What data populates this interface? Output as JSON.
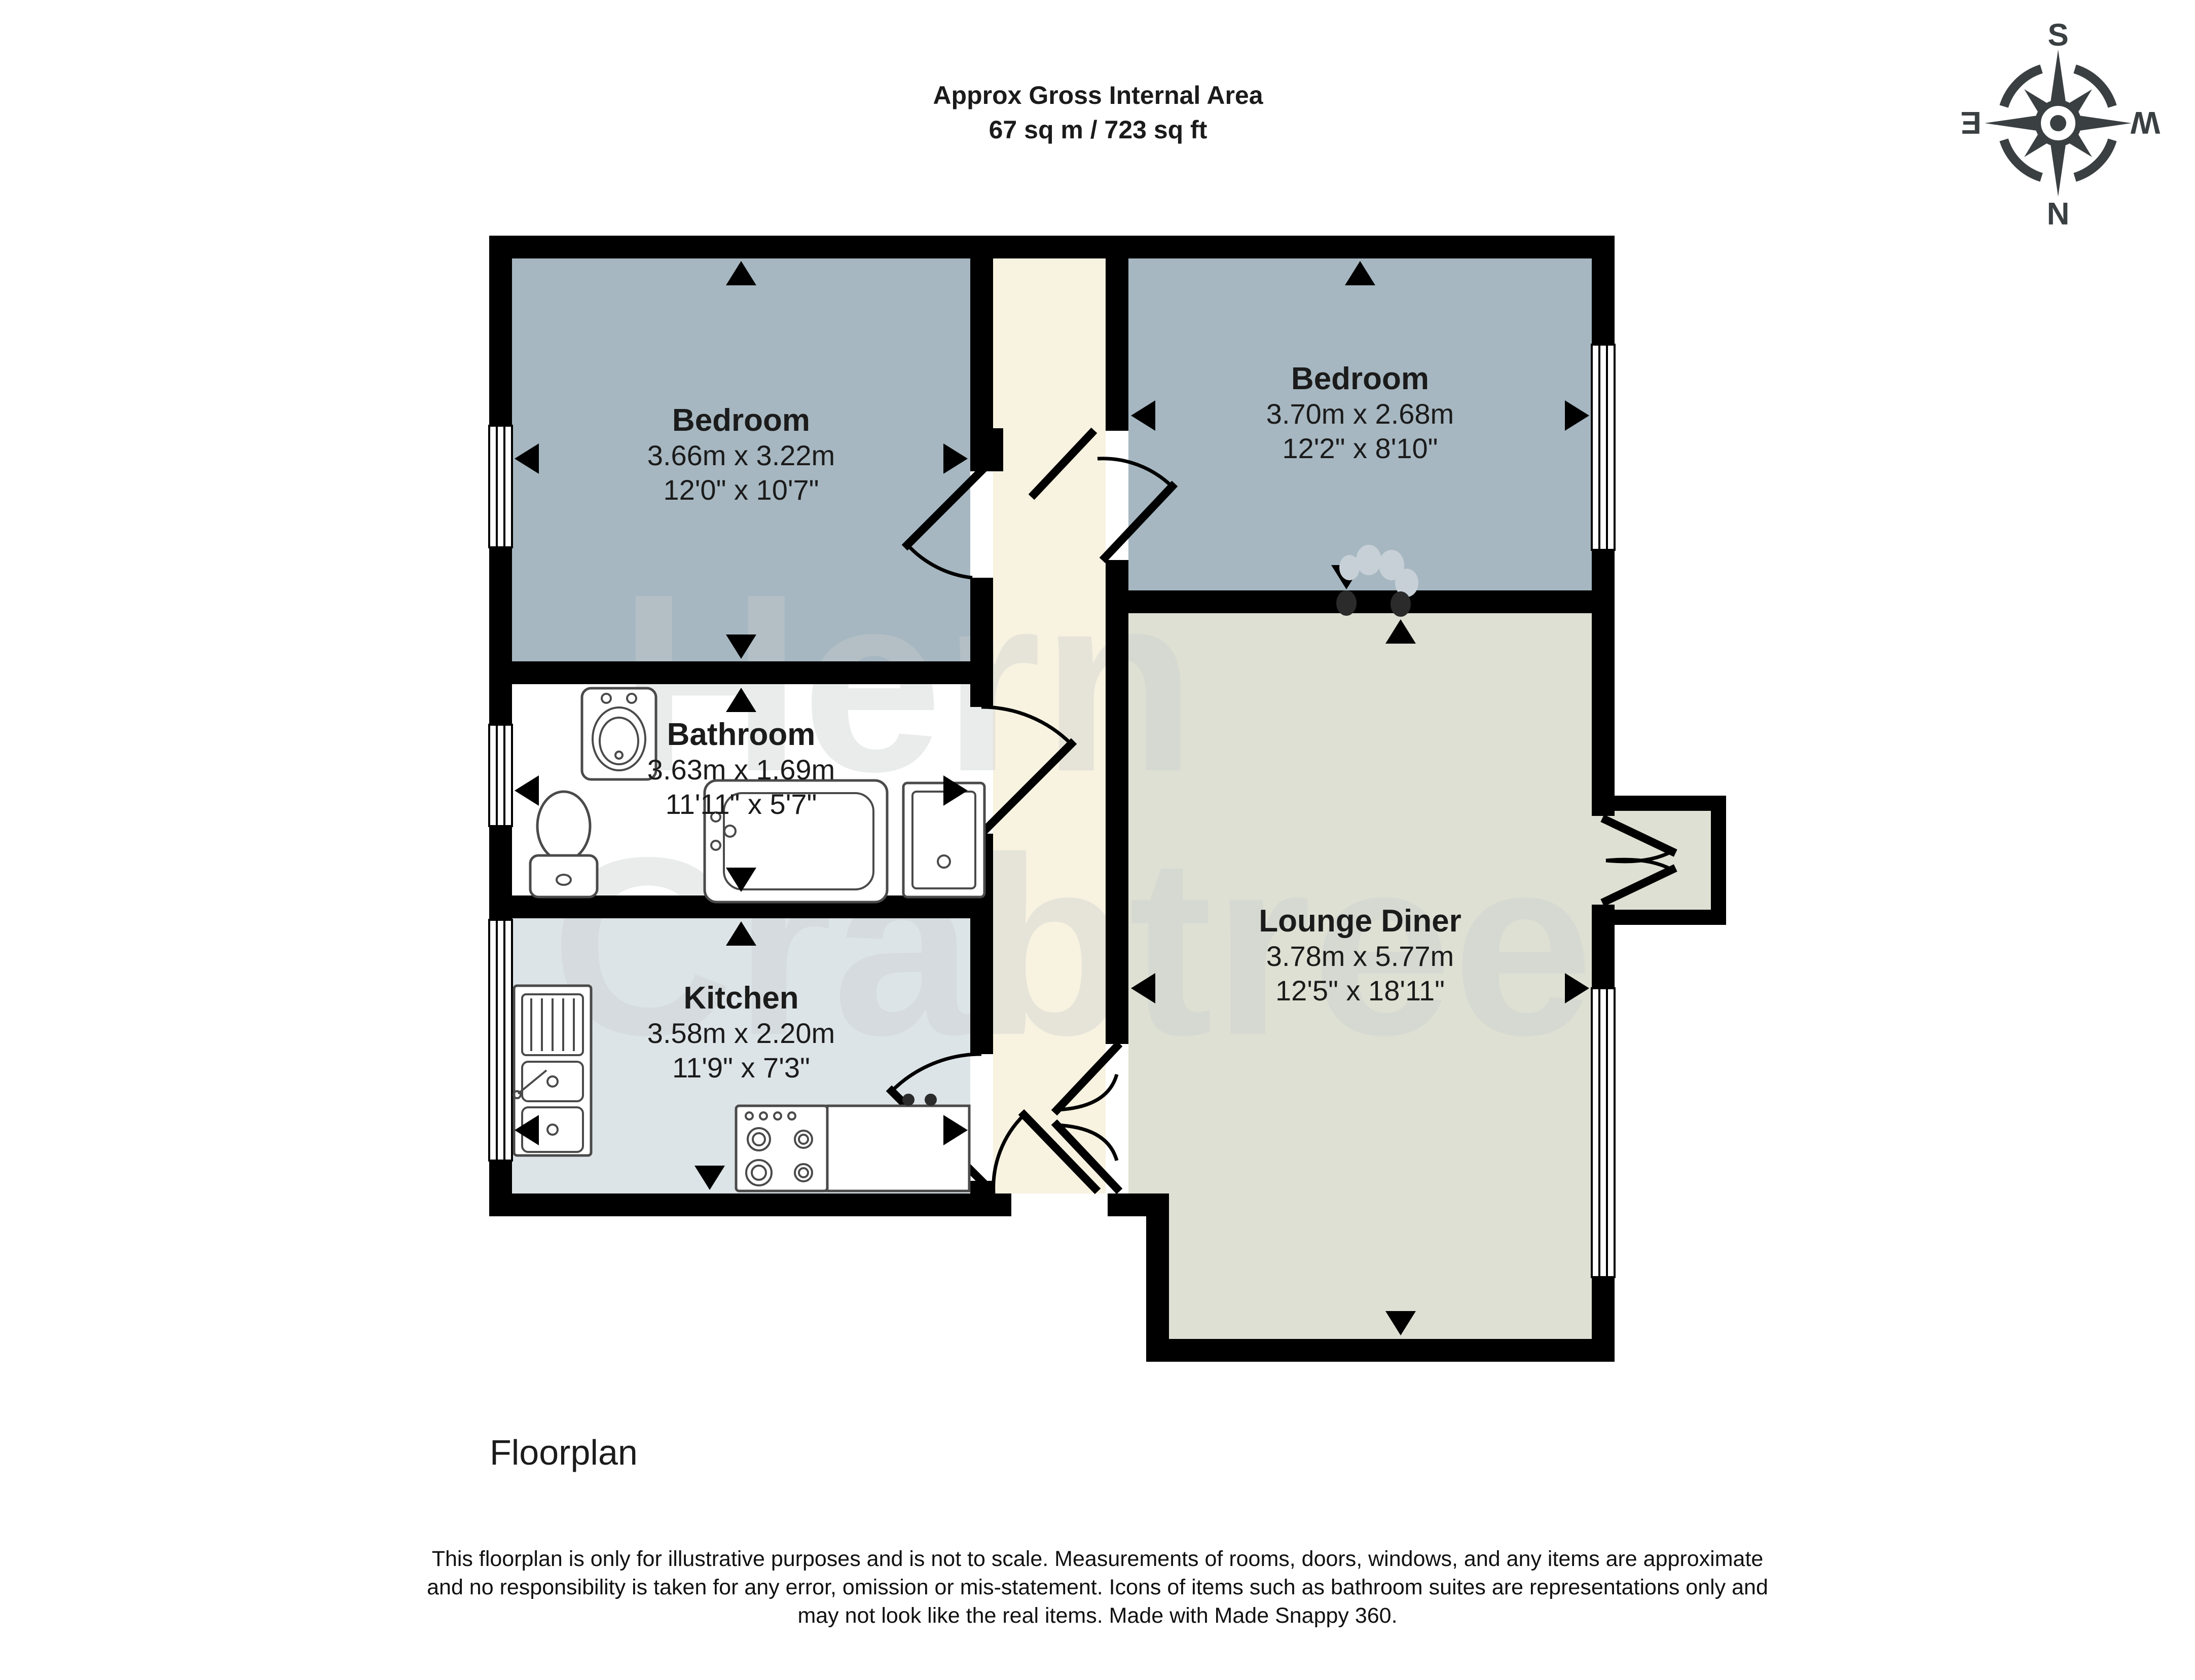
{
  "header": {
    "title_line1": "Approx Gross Internal Area",
    "title_line2": "67 sq m / 723 sq ft"
  },
  "compass": {
    "north": "N",
    "south": "S",
    "east": "E",
    "west": "W"
  },
  "rooms": {
    "bedroom1": {
      "name": "Bedroom",
      "metric": "3.66m x 3.22m",
      "imperial": "12'0\" x 10'7\""
    },
    "bedroom2": {
      "name": "Bedroom",
      "metric": "3.70m x 2.68m",
      "imperial": "12'2\" x 8'10\""
    },
    "bathroom": {
      "name": "Bathroom",
      "metric": "3.63m x 1.69m",
      "imperial": "11'11\" x 5'7\""
    },
    "kitchen": {
      "name": "Kitchen",
      "metric": "3.58m x 2.20m",
      "imperial": "11'9\" x 7'3\""
    },
    "lounge": {
      "name": "Lounge Diner",
      "metric": "3.78m x 5.77m",
      "imperial": "12'5\" x 18'11\""
    }
  },
  "watermark": {
    "line1": "Hern",
    "line2": "Crabtree"
  },
  "footer": {
    "caption": "Floorplan",
    "disclaimer_line1": "This floorplan is only for illustrative purposes and is not to scale. Measurements of rooms, doors, windows, and any items are approximate",
    "disclaimer_line2": "and no responsibility is taken for any error, omission or mis-statement. Icons of items such as bathroom suites are representations only and",
    "disclaimer_line3": "may not look like the real items. Made with Made Snappy 360."
  },
  "colors": {
    "wall": "#000000",
    "bedroom_fill": "#a6b7c1",
    "bathroom_fill": "#ffffff",
    "kitchen_fill": "#dde4e8",
    "lounge_fill": "#dee0d3",
    "hall_fill": "#f8f2e1",
    "watermark": "#c9cdce",
    "compass": "#3a3f42",
    "text": "#1b1b1b"
  }
}
